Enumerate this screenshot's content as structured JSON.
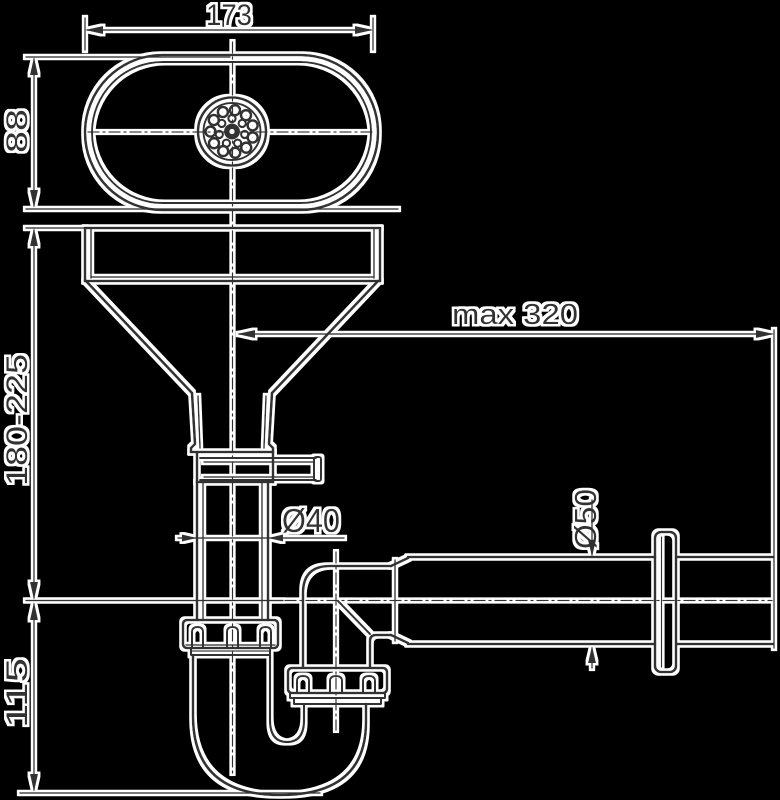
{
  "title": "sink-drain-siphon-technical-drawing",
  "dimensions": {
    "top_width": "173",
    "oval_depth": "88",
    "install_height_range": "180-225",
    "trap_depth": "115",
    "max_horizontal_reach": "max 320",
    "vertical_pipe_diameter": "Ø40",
    "outlet_pipe_diameter": "Ø50"
  },
  "colors": {
    "background": "#000000",
    "line": "#303030",
    "halo": "#ffffff"
  }
}
